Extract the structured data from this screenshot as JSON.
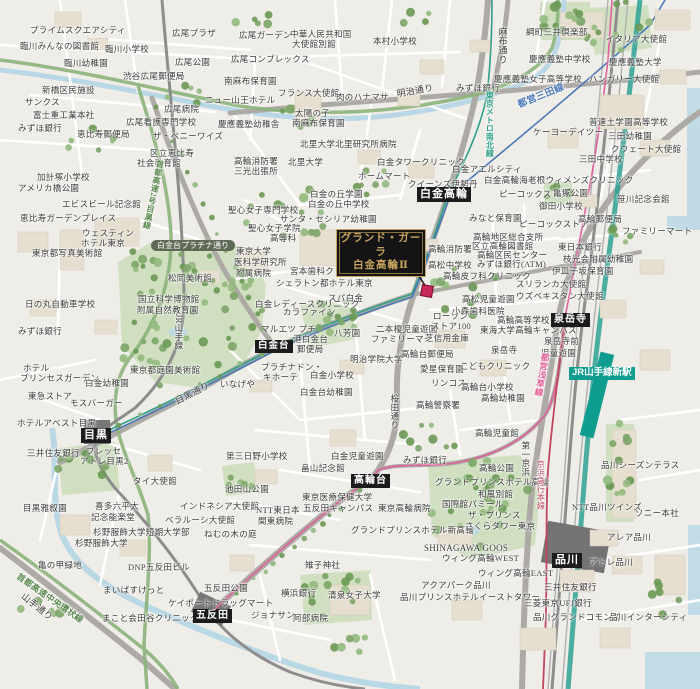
{
  "map": {
    "property": {
      "line1": "グランド・ガーラ",
      "line2": "白金高輪Ⅱ"
    },
    "colors": {
      "station_badge_bg": "#1c1c1c",
      "jr_new_station_bg": "#0f9d90",
      "road_badge_bg": "#5e6a55",
      "property_gold": "#c9a35f",
      "property_bg": "#141414",
      "marker_red": "#c7295b",
      "park_green": "#cfdfc0",
      "tree_green": "#7da668",
      "water_blue": "#b9d8e6",
      "expressway_green": "#8bb47a",
      "mita_line_blue": "#4a79b8",
      "namboku_line_green": "#2fa089",
      "asakusa_line_pink": "#e0619a",
      "keikyu_red": "#c0455e",
      "shinkansen_teal": "#2ea195"
    },
    "stations": [
      {
        "label": "白金高輪",
        "x": 417,
        "y": 187,
        "fs": 11,
        "type": "rail"
      },
      {
        "label": "白金台",
        "x": 255,
        "y": 340,
        "fs": 9.5,
        "type": "rail"
      },
      {
        "label": "目黒",
        "x": 81,
        "y": 428,
        "fs": 11,
        "type": "rail"
      },
      {
        "label": "高輪台",
        "x": 351,
        "y": 474,
        "fs": 10,
        "type": "rail"
      },
      {
        "label": "五反田",
        "x": 193,
        "y": 609,
        "fs": 10,
        "type": "rail"
      },
      {
        "label": "泉岳寺",
        "x": 551,
        "y": 313,
        "fs": 10,
        "type": "rail"
      },
      {
        "label": "品川",
        "x": 552,
        "y": 553,
        "fs": 11,
        "type": "rail"
      },
      {
        "label": "JR山手線新駅",
        "x": 569,
        "y": 367,
        "fs": 9.5,
        "type": "jr-new"
      },
      {
        "label": "白金台プラチナ通り",
        "x": 151,
        "y": 240,
        "fs": 8,
        "type": "road"
      }
    ],
    "labels": [
      {
        "t": "プライムスクエアシティ",
        "x": 30,
        "y": 26
      },
      {
        "t": "臨川みんなの図書館",
        "x": 20,
        "y": 42
      },
      {
        "t": "臨川小学校",
        "x": 105,
        "y": 45
      },
      {
        "t": "臨川幼稚園",
        "x": 64,
        "y": 59
      },
      {
        "t": "広尾プラザ",
        "x": 172,
        "y": 29
      },
      {
        "t": "広尾ガーデン",
        "x": 239,
        "y": 31
      },
      {
        "t": "広尾公園",
        "x": 175,
        "y": 58
      },
      {
        "t": "渋谷広尾郵便局",
        "x": 123,
        "y": 72
      },
      {
        "t": "新橋区民施設",
        "x": 42,
        "y": 86
      },
      {
        "t": "サンクス",
        "x": 25,
        "y": 98
      },
      {
        "t": "富士重工業本社",
        "x": 33,
        "y": 111
      },
      {
        "t": "みずほ銀行",
        "x": 18,
        "y": 124
      },
      {
        "t": "恵比寿郵便局",
        "x": 77,
        "y": 130
      },
      {
        "t": "広尾病院",
        "x": 164,
        "y": 105
      },
      {
        "t": "広尾看護専門学校",
        "x": 126,
        "y": 118
      },
      {
        "t": "ザ・ペニーワイズ",
        "x": 153,
        "y": 132
      },
      {
        "t": "区立恵比寿",
        "x": 150,
        "y": 149
      },
      {
        "t": "社会教育館",
        "x": 137,
        "y": 159
      },
      {
        "t": "ニュー山王ホテル",
        "x": 205,
        "y": 96
      },
      {
        "t": "広尾コンプレックス",
        "x": 231,
        "y": 55
      },
      {
        "t": "中華人民共和国",
        "x": 290,
        "y": 30
      },
      {
        "t": "大使館別館",
        "x": 292,
        "y": 40
      },
      {
        "t": "本村小学校",
        "x": 373,
        "y": 37
      },
      {
        "t": "南麻布保育園",
        "x": 224,
        "y": 77
      },
      {
        "t": "フランス大使館",
        "x": 278,
        "y": 89
      },
      {
        "t": "肉のハナマサ",
        "x": 336,
        "y": 93
      },
      {
        "t": "太陽の子",
        "x": 295,
        "y": 109
      },
      {
        "t": "南麻布保育園",
        "x": 292,
        "y": 119
      },
      {
        "t": "慶應義塾幼稚舎",
        "x": 218,
        "y": 120
      },
      {
        "t": "北里大学北里研究所病院",
        "x": 300,
        "y": 140
      },
      {
        "t": "北里大学",
        "x": 288,
        "y": 158
      },
      {
        "t": "高輪消防署",
        "x": 234,
        "y": 157
      },
      {
        "t": "三光出張所",
        "x": 234,
        "y": 167
      },
      {
        "t": "加計塚小学校",
        "x": 37,
        "y": 173
      },
      {
        "t": "綱町三井倶楽部",
        "x": 526,
        "y": 28
      },
      {
        "t": "イタリア大使館",
        "x": 606,
        "y": 35
      },
      {
        "t": "慶應義塾中学校",
        "x": 529,
        "y": 55
      },
      {
        "t": "慶應義塾大学",
        "x": 609,
        "y": 58
      },
      {
        "t": "慶應義塾女子高等学校",
        "x": 494,
        "y": 75
      },
      {
        "t": "ハンガリー大使館",
        "x": 589,
        "y": 75
      },
      {
        "t": "みずほ銀行",
        "x": 456,
        "y": 84
      },
      {
        "t": "普連土学園高等学校",
        "x": 589,
        "y": 118
      },
      {
        "t": "ケーヨーデイツー",
        "x": 533,
        "y": 128
      },
      {
        "t": "三田幼稚園",
        "x": 608,
        "y": 132
      },
      {
        "t": "クウェート大使館",
        "x": 611,
        "y": 145
      },
      {
        "t": "三田中学校",
        "x": 579,
        "y": 155
      },
      {
        "t": "白金タワークリニック",
        "x": 377,
        "y": 158
      },
      {
        "t": "ホームマート",
        "x": 358,
        "y": 172
      },
      {
        "t": "白金アエルシティ",
        "x": 452,
        "y": 165
      },
      {
        "t": "クイーンズ伊勢丹",
        "x": 408,
        "y": 180
      },
      {
        "t": "白金高輪海老根ウィメンズクリニック",
        "x": 484,
        "y": 176
      },
      {
        "t": "ピーコックストア",
        "x": 499,
        "y": 190
      },
      {
        "t": "亀塚公園",
        "x": 553,
        "y": 189
      },
      {
        "t": "御田小学校",
        "x": 539,
        "y": 202
      },
      {
        "t": "笹川記念会館",
        "x": 617,
        "y": 195
      },
      {
        "t": "高輪郵便局",
        "x": 578,
        "y": 215
      },
      {
        "t": "ファミリーマート",
        "x": 622,
        "y": 227
      },
      {
        "t": "みなと保育園",
        "x": 469,
        "y": 214
      },
      {
        "t": "ピーコックストア",
        "x": 519,
        "y": 220
      },
      {
        "t": "白金の丘学園",
        "x": 310,
        "y": 190
      },
      {
        "t": "白金の丘中学校",
        "x": 308,
        "y": 200
      },
      {
        "t": "聖心女子専門学校",
        "x": 228,
        "y": 206
      },
      {
        "t": "サンタ・セシリア幼稚園",
        "x": 280,
        "y": 215
      },
      {
        "t": "聖心女子学院",
        "x": 248,
        "y": 224
      },
      {
        "t": "高等科",
        "x": 270,
        "y": 234
      },
      {
        "t": "東京大学",
        "x": 236,
        "y": 247
      },
      {
        "t": "医科学研究所",
        "x": 234,
        "y": 258
      },
      {
        "t": "附属病院",
        "x": 236,
        "y": 269
      },
      {
        "t": "宮本歯科クリニック",
        "x": 290,
        "y": 267
      },
      {
        "t": "シェラトン都ホテル東京",
        "x": 276,
        "y": 279
      },
      {
        "t": "スパ白金",
        "x": 328,
        "y": 294
      },
      {
        "t": "白金レディースクリニック",
        "x": 255,
        "y": 300
      },
      {
        "t": "カラファイン",
        "x": 283,
        "y": 308
      },
      {
        "t": "マルエツ プチ",
        "x": 261,
        "y": 325
      },
      {
        "t": "港白金台",
        "x": 293,
        "y": 335
      },
      {
        "t": "郵便局",
        "x": 297,
        "y": 345
      },
      {
        "t": "八芳園",
        "x": 334,
        "y": 329
      },
      {
        "t": "二本榎児童遊園",
        "x": 376,
        "y": 325
      },
      {
        "t": "ファミリーマート",
        "x": 371,
        "y": 335
      },
      {
        "t": "芝信用金庫",
        "x": 425,
        "y": 334
      },
      {
        "t": "いなげや",
        "x": 220,
        "y": 380
      },
      {
        "t": "プラチナドン・",
        "x": 261,
        "y": 363
      },
      {
        "t": "キホーテ",
        "x": 263,
        "y": 373
      },
      {
        "t": "白金小学校",
        "x": 310,
        "y": 371
      },
      {
        "t": "白金台幼稚園",
        "x": 300,
        "y": 388
      },
      {
        "t": "明治学院大学",
        "x": 350,
        "y": 355
      },
      {
        "t": "高輪台郵便局",
        "x": 401,
        "y": 350
      },
      {
        "t": "愛星保育園",
        "x": 420,
        "y": 365
      },
      {
        "t": "リンコス",
        "x": 431,
        "y": 379
      },
      {
        "t": "高輪警察署",
        "x": 416,
        "y": 401
      },
      {
        "t": "高輪消防署",
        "x": 428,
        "y": 245
      },
      {
        "t": "高松中学校",
        "x": 428,
        "y": 261
      },
      {
        "t": "高輪地区総合支所",
        "x": 473,
        "y": 233
      },
      {
        "t": "区立高輪図書館",
        "x": 472,
        "y": 242
      },
      {
        "t": "高輪区民センター",
        "x": 477,
        "y": 251
      },
      {
        "t": "みずほ銀行(ATM)",
        "x": 477,
        "y": 260
      },
      {
        "t": "東日本銀行",
        "x": 558,
        "y": 243
      },
      {
        "t": "枝光会附属幼稚園",
        "x": 563,
        "y": 255
      },
      {
        "t": "伊皿子坂保育園",
        "x": 552,
        "y": 267
      },
      {
        "t": "スリランカ大使館",
        "x": 516,
        "y": 280
      },
      {
        "t": "ウズベキスタン大使館",
        "x": 516,
        "y": 292
      },
      {
        "t": "高輪皮フ科クリニック",
        "x": 443,
        "y": 272
      },
      {
        "t": "高松児童遊園",
        "x": 462,
        "y": 295
      },
      {
        "t": "小森歯科医院",
        "x": 452,
        "y": 307
      },
      {
        "t": "高輪高等学校",
        "x": 497,
        "y": 316
      },
      {
        "t": "東海大学高輪キャンパス",
        "x": 480,
        "y": 326
      },
      {
        "t": "ローソン",
        "x": 433,
        "y": 312
      },
      {
        "t": "ストア100",
        "x": 431,
        "y": 322
      },
      {
        "t": "泉岳寺",
        "x": 491,
        "y": 346
      },
      {
        "t": "泉岳寺前",
        "x": 544,
        "y": 337
      },
      {
        "t": "児童遊園",
        "x": 541,
        "y": 349
      },
      {
        "t": "アメリカ橋公園",
        "x": 18,
        "y": 184
      },
      {
        "t": "エビスビール記念館",
        "x": 62,
        "y": 200
      },
      {
        "t": "恵比寿ガーデンプレイス",
        "x": 20,
        "y": 214
      },
      {
        "t": "ウェスティン",
        "x": 82,
        "y": 229
      },
      {
        "t": "ホテル東京",
        "x": 81,
        "y": 239
      },
      {
        "t": "東京都写真美術館",
        "x": 32,
        "y": 249
      },
      {
        "t": "松岡美術館",
        "x": 168,
        "y": 274
      },
      {
        "t": "国立科学博物館",
        "x": 138,
        "y": 295
      },
      {
        "t": "附属自然教育園",
        "x": 137,
        "y": 306
      },
      {
        "t": "日の丸自動車学校",
        "x": 25,
        "y": 300
      },
      {
        "t": "みずほ銀行",
        "x": 18,
        "y": 327
      },
      {
        "t": "ホテル",
        "x": 23,
        "y": 364
      },
      {
        "t": "プリンセスガーデン",
        "x": 20,
        "y": 374
      },
      {
        "t": "東京都庭園美術館",
        "x": 130,
        "y": 366
      },
      {
        "t": "白金幼稚園",
        "x": 85,
        "y": 379
      },
      {
        "t": "東急ストア",
        "x": 28,
        "y": 392
      },
      {
        "t": "モスバーガー",
        "x": 70,
        "y": 399
      },
      {
        "t": "ホテルアベスト目黒",
        "x": 17,
        "y": 419
      },
      {
        "t": "三井住友銀行",
        "x": 27,
        "y": 449
      },
      {
        "t": "プレッセ",
        "x": 86,
        "y": 447
      },
      {
        "t": "アトレ目黒2",
        "x": 80,
        "y": 457
      },
      {
        "t": "タイ大使館",
        "x": 133,
        "y": 477
      },
      {
        "t": "目黒雅叙園",
        "x": 23,
        "y": 504
      },
      {
        "t": "インドネシア大使館",
        "x": 180,
        "y": 502
      },
      {
        "t": "池田山公園",
        "x": 225,
        "y": 485
      },
      {
        "t": "喜多六平太",
        "x": 95,
        "y": 502
      },
      {
        "t": "記念能楽堂",
        "x": 91,
        "y": 513
      },
      {
        "t": "杉野服飾大学短期大学部",
        "x": 93,
        "y": 528
      },
      {
        "t": "杉野服飾大学",
        "x": 75,
        "y": 539
      },
      {
        "t": "ベラルーシ大使館",
        "x": 165,
        "y": 516
      },
      {
        "t": "ねむの木の庭",
        "x": 204,
        "y": 530
      },
      {
        "t": "亀の甲緑地",
        "x": 38,
        "y": 561
      },
      {
        "t": "DNP五反田ビル",
        "x": 128,
        "y": 563
      },
      {
        "t": "まいばすけっと",
        "x": 103,
        "y": 586
      },
      {
        "t": "五反田公園",
        "x": 204,
        "y": 584
      },
      {
        "t": "ケイポートドラッグマート",
        "x": 168,
        "y": 599
      },
      {
        "t": "まこと会田谷クリニック",
        "x": 102,
        "y": 614
      },
      {
        "t": "第三日野小学校",
        "x": 226,
        "y": 452
      },
      {
        "t": "白金児童遊園",
        "x": 331,
        "y": 452
      },
      {
        "t": "畠山記念館",
        "x": 301,
        "y": 464
      },
      {
        "t": "みずほ銀行",
        "x": 403,
        "y": 456
      },
      {
        "t": "東京医療保健大学",
        "x": 302,
        "y": 493
      },
      {
        "t": "五反田キャンパス",
        "x": 303,
        "y": 504
      },
      {
        "t": "NTT東日本",
        "x": 256,
        "y": 506
      },
      {
        "t": "関東病院",
        "x": 258,
        "y": 517
      },
      {
        "t": "東京高輪病院",
        "x": 378,
        "y": 504
      },
      {
        "t": "雉子神社",
        "x": 305,
        "y": 561
      },
      {
        "t": "グランドプリンスホテル新高輪",
        "x": 351,
        "y": 526
      },
      {
        "t": "横浜銀行",
        "x": 281,
        "y": 589
      },
      {
        "t": "清泉女子大学",
        "x": 328,
        "y": 591
      },
      {
        "t": "ジョナサン",
        "x": 251,
        "y": 611
      },
      {
        "t": "阿部病院",
        "x": 293,
        "y": 614
      },
      {
        "t": "SHINAGAWA GOOS",
        "x": 424,
        "y": 544,
        "fs": 9
      },
      {
        "t": "ウィング高輪WEST",
        "x": 442,
        "y": 554
      },
      {
        "t": "ウィング高輪EAST",
        "x": 478,
        "y": 569
      },
      {
        "t": "アクアパーク品川",
        "x": 421,
        "y": 581
      },
      {
        "t": "品川プリンスホテルイーストタワー",
        "x": 400,
        "y": 593
      },
      {
        "t": "グランドプリンスホテル高輪",
        "x": 435,
        "y": 478
      },
      {
        "t": "和風別館",
        "x": 478,
        "y": 490
      },
      {
        "t": "国際館パミール",
        "x": 442,
        "y": 500
      },
      {
        "t": "ザ・プリンス",
        "x": 468,
        "y": 511
      },
      {
        "t": "さくらタワー東京",
        "x": 465,
        "y": 522
      },
      {
        "t": "高輪児童館",
        "x": 475,
        "y": 429
      },
      {
        "t": "高輪公園",
        "x": 479,
        "y": 464
      },
      {
        "t": "高輪台小学校",
        "x": 461,
        "y": 383
      },
      {
        "t": "高輪幼稚園",
        "x": 481,
        "y": 394
      },
      {
        "t": "こどもクリニック",
        "x": 460,
        "y": 362
      },
      {
        "t": "品川シーズンテラス",
        "x": 601,
        "y": 461
      },
      {
        "t": "NTT品川ツインズ",
        "x": 572,
        "y": 503
      },
      {
        "t": "ソニー本社",
        "x": 635,
        "y": 509
      },
      {
        "t": "アレア品川",
        "x": 607,
        "y": 533
      },
      {
        "t": "アトレ品川",
        "x": 589,
        "y": 558
      },
      {
        "t": "三井住友銀行",
        "x": 544,
        "y": 583
      },
      {
        "t": "三菱東京UFJ銀行",
        "x": 524,
        "y": 599
      },
      {
        "t": "品川グランドコモンズ",
        "x": 533,
        "y": 613
      },
      {
        "t": "品川インターシティ",
        "x": 609,
        "y": 613
      },
      {
        "t": "明治通り",
        "x": 396,
        "y": 90,
        "r": -10,
        "fs": 9
      },
      {
        "t": "目黒通り",
        "x": 174,
        "y": 398,
        "r": -27,
        "fs": 9
      },
      {
        "t": "山手通り",
        "x": 25,
        "y": 592,
        "r": 38,
        "fs": 9
      },
      {
        "t": "麻布通り",
        "x": 497,
        "y": 27,
        "v": 1,
        "fs": 9
      },
      {
        "t": "桜田通り",
        "x": 390,
        "y": 394,
        "v": 1,
        "fs": 8.5
      },
      {
        "t": "JR山手線",
        "x": 174,
        "y": 314,
        "v": 1,
        "fs": 8.5
      },
      {
        "t": "第一京浜",
        "x": 521,
        "y": 441,
        "v": 1,
        "fs": 8.5
      },
      {
        "t": "京浜急行本線",
        "x": 536,
        "y": 460,
        "v": 1,
        "fs": 8,
        "c": "#c0455e"
      },
      {
        "t": "都営浅草線",
        "x": 541,
        "y": 353,
        "v": 1,
        "r": 10,
        "fs": 8.5,
        "c": "#e0619a",
        "b": 1
      },
      {
        "t": "都営三田線",
        "x": 517,
        "y": 102,
        "r": -22,
        "fs": 9.5,
        "c": "#4a79b8",
        "b": 1
      },
      {
        "t": "東京メトロ南北線",
        "x": 485,
        "y": 91,
        "v": 1,
        "fs": 8,
        "c": "#2fa089",
        "b": 1
      },
      {
        "t": "首都高速2号目黒線",
        "x": 156,
        "y": 160,
        "v": 1,
        "r": 12,
        "fs": 8,
        "c": "#5a8a4f",
        "b": 1
      },
      {
        "t": "首都高速中央環状線",
        "x": 20,
        "y": 572,
        "r": 35,
        "fs": 8.5,
        "c": "#5a8a4f",
        "b": 1
      }
    ]
  }
}
